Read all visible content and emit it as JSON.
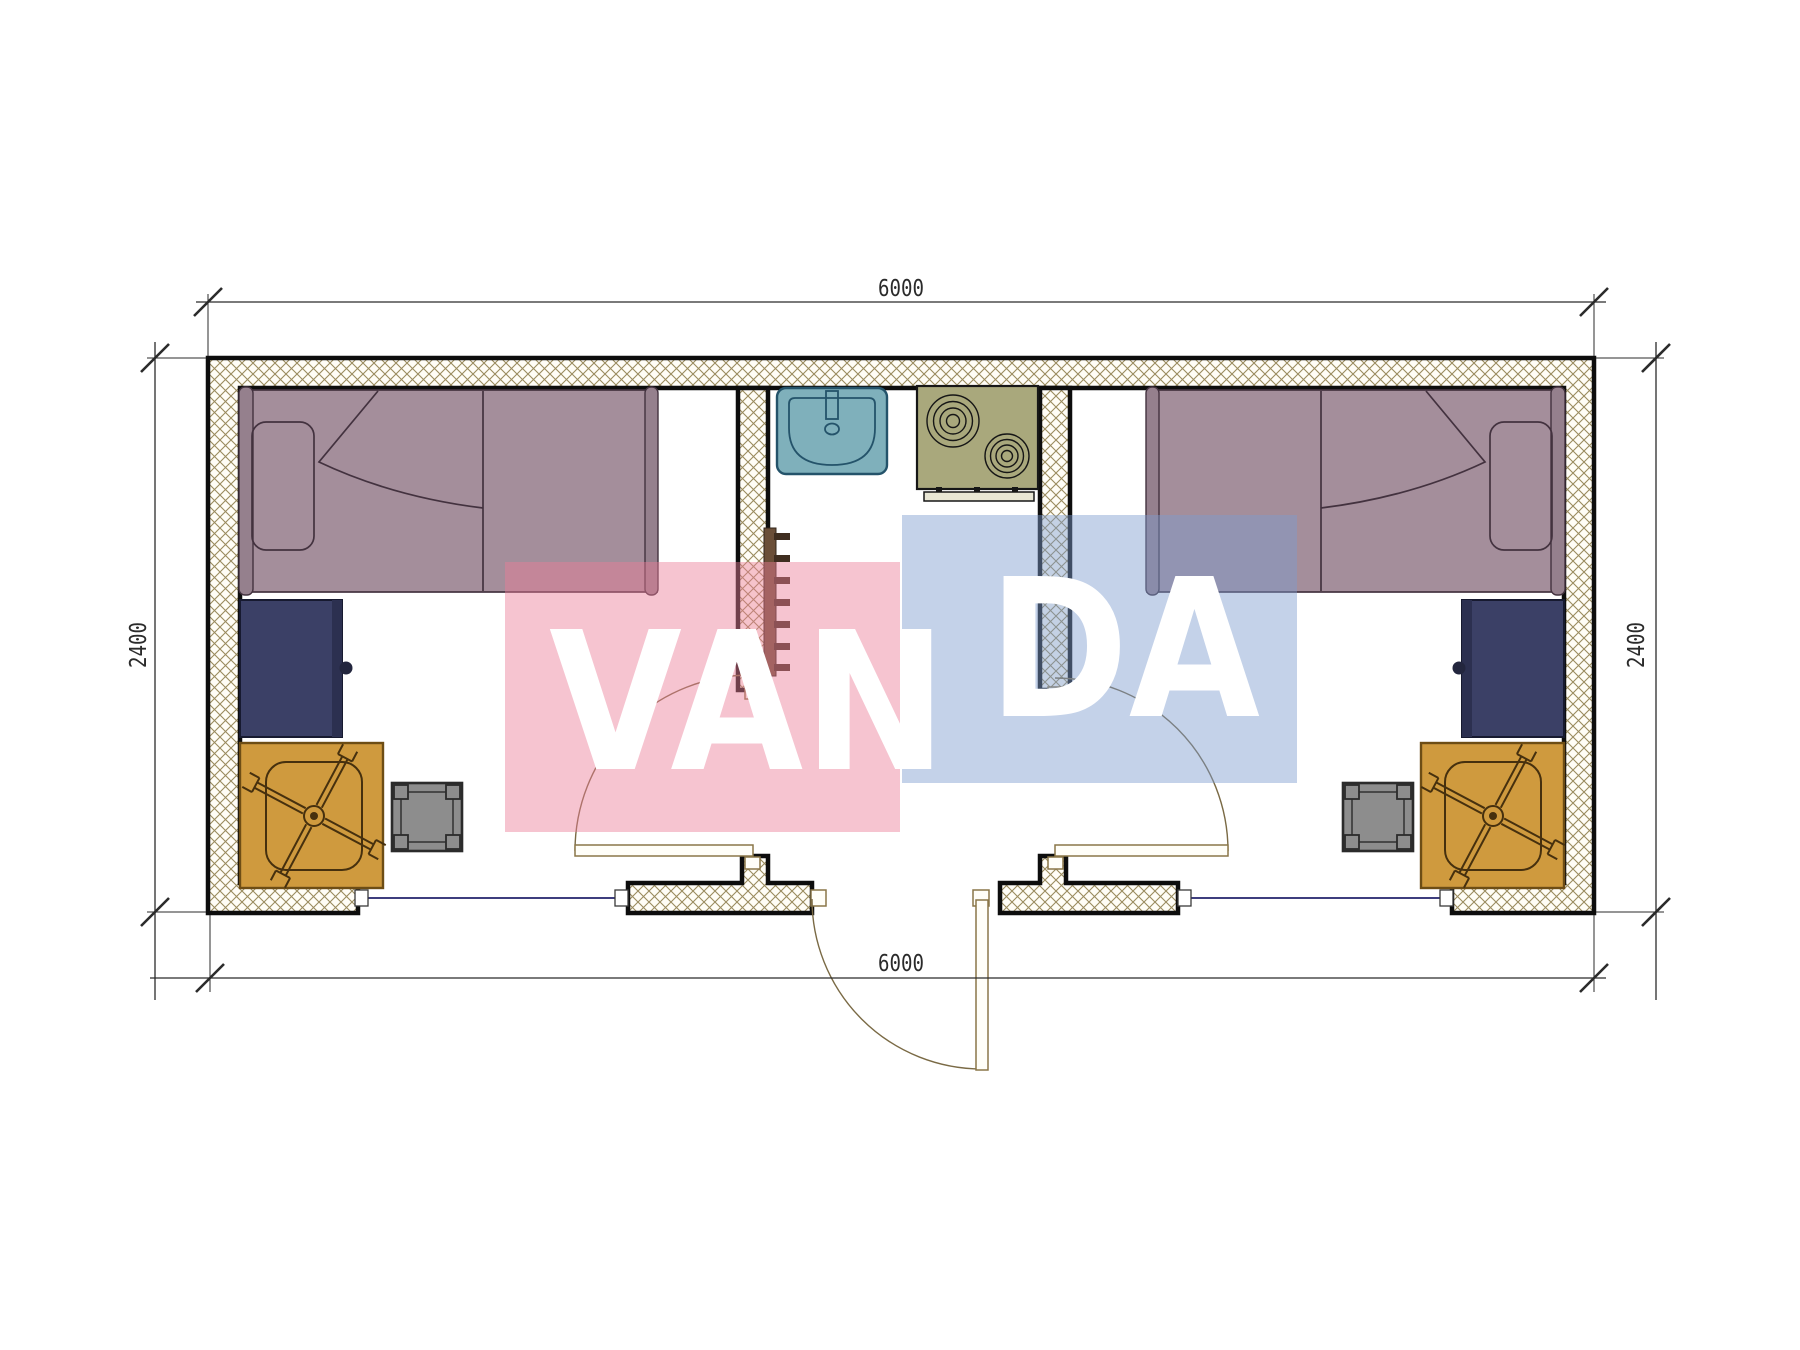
{
  "drawing": {
    "dim_top": "6000",
    "dim_bottom": "6000",
    "dim_left": "2400",
    "dim_right": "2400"
  },
  "watermark": {
    "text_left": "VAN",
    "text_right": "DA",
    "pink_fill": "rgba(235,124,150,0.45)",
    "blue_fill": "rgba(124,156,206,0.45)",
    "text_color": "#ffffff"
  },
  "colors": {
    "wall_hatch_line": "#9a8b5e",
    "bed": "#a48e9b",
    "bed_bar": "#95808d",
    "cabinet": "#3b4066",
    "cabinet_edge": "#2c3050",
    "desk": "#cf9a3e",
    "stool": "#8d8d8d",
    "sink": "#7fb0bb",
    "stove": "#a9a87c",
    "stove_panel": "#e8e6d4",
    "towel_rail": "#6b4f38",
    "towel_tab": "#3f2e20"
  }
}
